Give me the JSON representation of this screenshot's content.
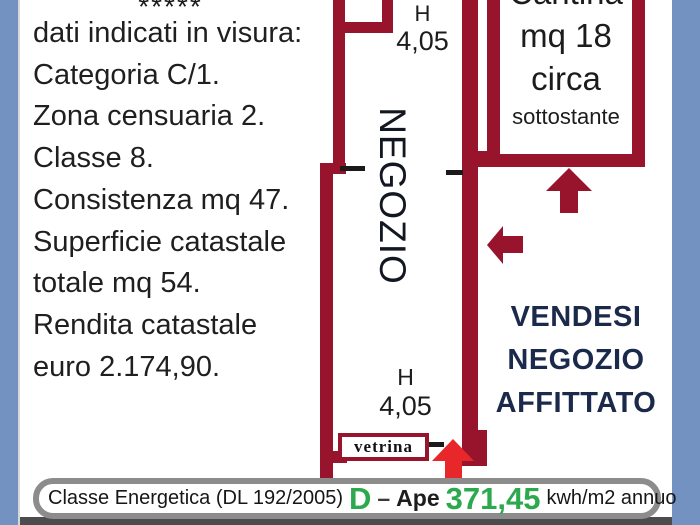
{
  "colors": {
    "wall_red": "#97142C",
    "entrance_arrow_red": "#E8272B",
    "side_strip_blue": "#7391C1",
    "energy_green": "#2CA94D",
    "sale_sign_navy": "#1B2A4A",
    "banner_border_gray": "#8C8C8C",
    "bottom_bar_gray": "#4C4C4C"
  },
  "left_panel": {
    "stars": "*****",
    "lines": [
      "dati indicati in visura:",
      "Categoria C/1.",
      "Zona censuaria 2.",
      "Classe 8.",
      "Consistenza mq 47.",
      "Superficie catastale",
      "totale mq 54.",
      "Rendita catastale",
      "euro 2.174,90."
    ]
  },
  "floor_plan": {
    "room_label": "NEGOZIO",
    "ceiling_height_top": {
      "h": "H",
      "value": "4,05"
    },
    "ceiling_height_bottom": {
      "h": "H",
      "value": "4,05"
    },
    "vetrina_label": "vetrina",
    "cantina": {
      "title": "Cantina",
      "area": "mq 18",
      "circa": "circa",
      "note": "sottostante"
    }
  },
  "sale_sign": {
    "lines": [
      "VENDESI",
      "NEGOZIO",
      "AFFITTATO"
    ]
  },
  "energy_banner": {
    "label": "Classe Energetica (DL 192/2005)",
    "class_letter": "D",
    "separator": "–",
    "ape": "Ape",
    "value": "371,45",
    "unit": "kwh/m2 annuo"
  }
}
